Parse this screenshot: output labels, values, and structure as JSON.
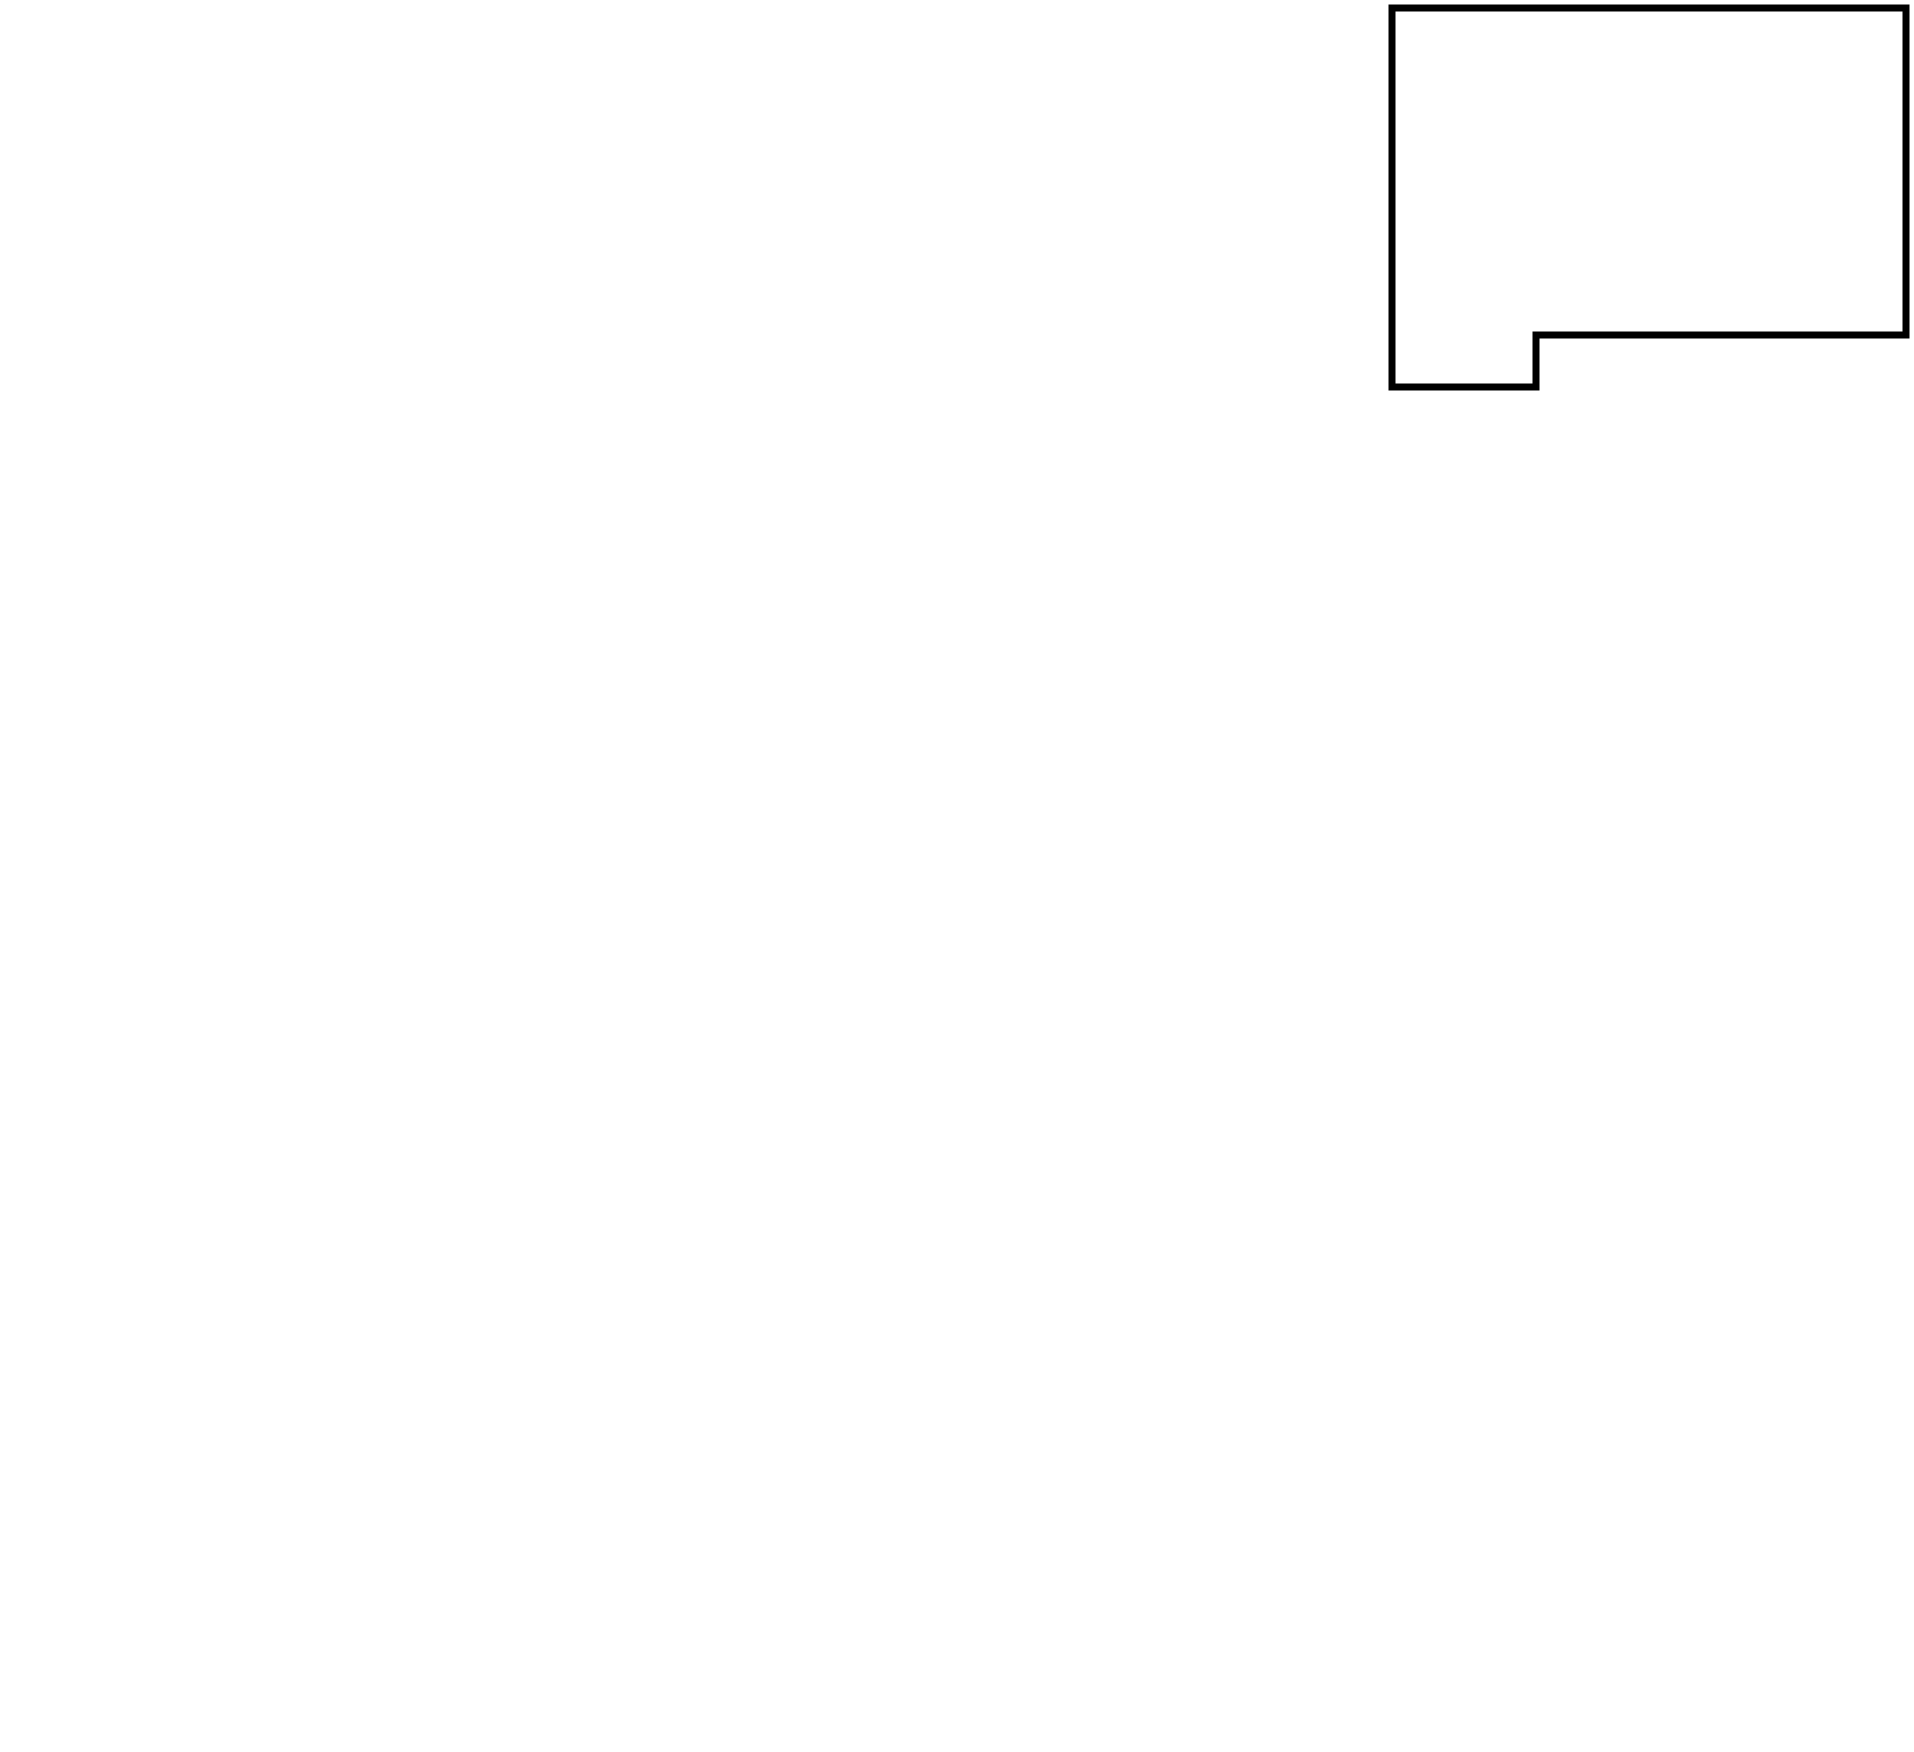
{
  "map": {
    "background_color": "#ffffff",
    "border_color": "#000000",
    "cell_fill_color": "#ffffff",
    "text_color": "#000000",
    "prefectures": [
      {
        "id": "hokkaido",
        "name": "北海道",
        "value": 19,
        "poly": [
          [
            1392,
            8
          ],
          [
            1906,
            8
          ],
          [
            1906,
            335
          ],
          [
            1536,
            335
          ],
          [
            1536,
            387
          ],
          [
            1392,
            387
          ]
        ],
        "label": [
          1628,
          180,
          "h"
        ]
      },
      {
        "id": "aomori",
        "name": "青森",
        "value": 12,
        "rect": [
          1390,
          430,
          372,
          113
        ],
        "label": [
          1578,
          492,
          "h"
        ]
      },
      {
        "id": "akita",
        "name": "秋田",
        "value": 7,
        "rect": [
          1390,
          543,
          188,
          139
        ],
        "label": [
          1484,
          616,
          "h"
        ]
      },
      {
        "id": "iwate",
        "name": "岩手",
        "value": 10,
        "rect": [
          1578,
          543,
          184,
          139
        ],
        "label": [
          1670,
          616,
          "h"
        ]
      },
      {
        "id": "yamagata",
        "name": "山形",
        "value": 2,
        "poly": [
          [
            1390,
            682
          ],
          [
            1578,
            682
          ],
          [
            1578,
            822
          ],
          [
            1462,
            822
          ],
          [
            1462,
            775
          ],
          [
            1390,
            775
          ]
        ],
        "label": [
          1518,
          756,
          "h"
        ]
      },
      {
        "id": "miyagi",
        "name": "宮城",
        "value": 8,
        "rect": [
          1578,
          682,
          184,
          140
        ],
        "label": [
          1670,
          748,
          "h"
        ]
      },
      {
        "id": "fukushima",
        "name": "福島",
        "value": 5,
        "rect": [
          1462,
          822,
          300,
          140
        ],
        "label": [
          1628,
          892,
          "h"
        ]
      },
      {
        "id": "niigata",
        "name": "新潟",
        "value": 5,
        "poly": [
          [
            1390,
            775
          ],
          [
            1462,
            775
          ],
          [
            1462,
            962
          ],
          [
            1285,
            962
          ],
          [
            1285,
            822
          ],
          [
            1390,
            822
          ]
        ],
        "label": [
          1374,
          892,
          "h"
        ]
      },
      {
        "id": "toyama",
        "name": "富山",
        "value": 3,
        "rect": [
          1143,
          822,
          142,
          140
        ],
        "label": [
          1214,
          892,
          "h"
        ]
      },
      {
        "id": "ishikawa",
        "name": "石川",
        "value": 8,
        "rect": [
          1047,
          780,
          96,
          182
        ],
        "label": [
          1095,
          875,
          "v"
        ]
      },
      {
        "id": "fukui",
        "name": "福井",
        "value": 6,
        "poly": [
          [
            1047,
            960
          ],
          [
            1143,
            960
          ],
          [
            1143,
            1100
          ],
          [
            957,
            1100
          ],
          [
            957,
            1003
          ],
          [
            1047,
            1003
          ]
        ],
        "label": [
          1052,
          1046,
          "h"
        ]
      },
      {
        "id": "gifu",
        "name": "岐阜",
        "value": null,
        "rect": [
          1143,
          960,
          92,
          368
        ],
        "label": [
          1189,
          1182,
          "v"
        ]
      },
      {
        "id": "nagano",
        "name": "長野",
        "value": null,
        "poly": [
          [
            1235,
            960
          ],
          [
            1397,
            960
          ],
          [
            1397,
            1212
          ],
          [
            1327,
            1212
          ],
          [
            1327,
            1328
          ],
          [
            1235,
            1328
          ]
        ],
        "label": [
          1313,
          1150,
          "h"
        ]
      },
      {
        "id": "gunma",
        "name": "群馬",
        "value": null,
        "rect": [
          1397,
          962,
          136,
          135
        ],
        "label": [
          1462,
          1033,
          "h"
        ]
      },
      {
        "id": "tochigi",
        "name": "栃木",
        "value": null,
        "rect": [
          1533,
          962,
          135,
          135
        ],
        "label": [
          1600,
          1033,
          "h"
        ]
      },
      {
        "id": "ibaraki",
        "name": "茨城",
        "value": 8,
        "rect": [
          1677,
          962,
          85,
          178
        ],
        "label": [
          1716,
          1041,
          "v"
        ]
      },
      {
        "id": "saitama",
        "name": "埼玉",
        "value": null,
        "rect": [
          1397,
          1097,
          271,
          115
        ],
        "label": [
          1535,
          1167,
          "h"
        ]
      },
      {
        "id": "yamanashi",
        "name": "山梨",
        "value": null,
        "rect": [
          1327,
          1212,
          138,
          116
        ],
        "label": [
          1394,
          1292,
          "h"
        ]
      },
      {
        "id": "tokyo",
        "name": "東京",
        "value": 7,
        "poly": [
          [
            1465,
            1212
          ],
          [
            1668,
            1212
          ],
          [
            1668,
            1279
          ],
          [
            1603,
            1279
          ],
          [
            1603,
            1328
          ],
          [
            1465,
            1328
          ]
        ],
        "label": [
          1548,
          1268,
          "h"
        ]
      },
      {
        "id": "chiba",
        "name": "千葉",
        "value": 19,
        "rect": [
          1677,
          1140,
          85,
          322
        ],
        "label": [
          1717,
          1278,
          "v"
        ]
      },
      {
        "id": "kanagawa",
        "name": "神奈川",
        "value": 13,
        "poly": [
          [
            1397,
            1328
          ],
          [
            1603,
            1328
          ],
          [
            1603,
            1467
          ],
          [
            1470,
            1467
          ],
          [
            1470,
            1399
          ],
          [
            1397,
            1399
          ]
        ],
        "label": [
          1512,
          1397,
          "h"
        ]
      },
      {
        "id": "shizuoka",
        "name": "静岡",
        "value": 14,
        "poly": [
          [
            1280,
            1328
          ],
          [
            1397,
            1328
          ],
          [
            1397,
            1399
          ],
          [
            1470,
            1399
          ],
          [
            1470,
            1467
          ],
          [
            1280,
            1467
          ]
        ],
        "label": [
          1339,
          1402,
          "h"
        ]
      },
      {
        "id": "aichi",
        "name": "愛知",
        "value": 7,
        "rect": [
          1143,
          1328,
          137,
          139
        ],
        "label": [
          1214,
          1402,
          "h"
        ]
      },
      {
        "id": "mie",
        "name": "三重",
        "value": 8,
        "rect": [
          1047,
          1238,
          96,
          323
        ],
        "label": [
          1092,
          1379,
          "v"
        ]
      },
      {
        "id": "shiga",
        "name": "滋賀",
        "value": null,
        "rect": [
          1047,
          1100,
          96,
          136
        ],
        "label": [
          1093,
          1177,
          "v"
        ]
      },
      {
        "id": "kyoto",
        "name": "京都",
        "value": 3,
        "poly": [
          [
            865,
            1003
          ],
          [
            957,
            1003
          ],
          [
            957,
            1100
          ],
          [
            1047,
            1100
          ],
          [
            1047,
            1236
          ],
          [
            865,
            1236
          ]
        ],
        "label": [
          955,
          1160,
          "h"
        ]
      },
      {
        "id": "osaka",
        "name": "大阪",
        "value": 4,
        "rect": [
          865,
          1238,
          92,
          161
        ],
        "label": [
          911,
          1316,
          "v"
        ]
      },
      {
        "id": "nara",
        "name": "奈良",
        "value": null,
        "rect": [
          957,
          1238,
          90,
          234
        ],
        "label": [
          1001,
          1360,
          "v"
        ]
      },
      {
        "id": "wakayama",
        "name": "和歌山",
        "value": 8,
        "poly": [
          [
            865,
            1399
          ],
          [
            957,
            1399
          ],
          [
            957,
            1472
          ],
          [
            1047,
            1472
          ],
          [
            1047,
            1561
          ],
          [
            865,
            1561
          ]
        ],
        "label": [
          953,
          1494,
          "h"
        ]
      },
      {
        "id": "hyogo",
        "name": "兵庫",
        "value": 7,
        "rect": [
          772,
          1003,
          93,
          282
        ],
        "label": [
          818,
          1141,
          "v"
        ]
      },
      {
        "id": "tottori",
        "name": "鳥取",
        "value": 4,
        "rect": [
          680,
          1003,
          92,
          142
        ],
        "label": [
          728,
          1079,
          "v"
        ]
      },
      {
        "id": "okayama",
        "name": "岡山",
        "value": 2,
        "rect": [
          680,
          1145,
          92,
          140
        ],
        "label": [
          729,
          1214,
          "v"
        ]
      },
      {
        "id": "shimane",
        "name": "島根",
        "value": 4,
        "rect": [
          588,
          1003,
          92,
          142
        ],
        "label": [
          634,
          1078,
          "v"
        ]
      },
      {
        "id": "hiroshima",
        "name": "広島",
        "value": 5,
        "rect": [
          588,
          1145,
          92,
          140
        ],
        "label": [
          637,
          1214,
          "v"
        ]
      },
      {
        "id": "yamaguchi",
        "name": "山口",
        "value": 6,
        "rect": [
          492,
          1003,
          96,
          282
        ],
        "label": [
          542,
          1126,
          "v"
        ]
      },
      {
        "id": "ehime",
        "name": "愛媛",
        "value": 11,
        "rect": [
          492,
          1323,
          165,
          120
        ],
        "label": [
          577,
          1384,
          "h"
        ]
      },
      {
        "id": "kagawa",
        "name": "香川",
        "value": 8,
        "rect": [
          657,
          1323,
          163,
          120
        ],
        "label": [
          738,
          1384,
          "h"
        ]
      },
      {
        "id": "kochi",
        "name": "高知",
        "value": 6,
        "rect": [
          492,
          1443,
          165,
          117
        ],
        "label": [
          577,
          1502,
          "h"
        ]
      },
      {
        "id": "tokushima",
        "name": "徳島",
        "value": 5,
        "rect": [
          657,
          1443,
          163,
          117
        ],
        "label": [
          738,
          1502,
          "h"
        ]
      },
      {
        "id": "nagasaki",
        "name": "長崎",
        "value": 9,
        "rect": [
          32,
          1003,
          98,
          212
        ],
        "label": [
          85,
          1122,
          "v"
        ]
      },
      {
        "id": "saga",
        "name": "佐賀",
        "value": 3,
        "rect": [
          130,
          1003,
          90,
          212
        ],
        "label": [
          177,
          1122,
          "v"
        ]
      },
      {
        "id": "fukuoka",
        "name": "福岡",
        "value": 7,
        "poly": [
          [
            220,
            1003
          ],
          [
            450,
            1003
          ],
          [
            450,
            1098
          ],
          [
            355,
            1098
          ],
          [
            355,
            1215
          ],
          [
            220,
            1215
          ]
        ],
        "label": [
          290,
          1102,
          "h"
        ]
      },
      {
        "id": "oita",
        "name": "大分",
        "value": 6,
        "rect": [
          355,
          1098,
          95,
          162
        ],
        "label": [
          404,
          1180,
          "v"
        ]
      },
      {
        "id": "kumamoto",
        "name": "熊本",
        "value": 5,
        "rect": [
          220,
          1215,
          135,
          207
        ],
        "label": [
          289,
          1318,
          "h"
        ]
      },
      {
        "id": "miyazaki",
        "name": "宮崎",
        "value": 6,
        "rect": [
          355,
          1260,
          95,
          162
        ],
        "label": [
          404,
          1336,
          "v"
        ]
      },
      {
        "id": "kagoshima",
        "name": "鹿児島",
        "value": 16,
        "rect": [
          220,
          1422,
          230,
          133
        ],
        "label": [
          340,
          1498,
          "h"
        ]
      },
      {
        "id": "okinawa",
        "name": "沖縄",
        "value": 28,
        "rect": [
          220,
          1603,
          97,
          144
        ],
        "label": [
          268,
          1678,
          "v"
        ]
      }
    ],
    "coast_outlines": [
      {
        "id": "hokkaido-coast",
        "poly": [
          [
            1392,
            8
          ],
          [
            1906,
            8
          ],
          [
            1906,
            335
          ],
          [
            1536,
            335
          ],
          [
            1536,
            387
          ],
          [
            1392,
            387
          ]
        ]
      },
      {
        "id": "honshu-coast",
        "poly": [
          [
            1390,
            430
          ],
          [
            1762,
            430
          ],
          [
            1762,
            1462
          ],
          [
            1677,
            1462
          ],
          [
            1677,
            1279
          ],
          [
            1603,
            1279
          ],
          [
            1603,
            1467
          ],
          [
            1143,
            1467
          ],
          [
            1143,
            1561
          ],
          [
            865,
            1561
          ],
          [
            865,
            1285
          ],
          [
            492,
            1285
          ],
          [
            492,
            1003
          ],
          [
            1047,
            1003
          ],
          [
            1047,
            780
          ],
          [
            1143,
            780
          ],
          [
            1143,
            822
          ],
          [
            1390,
            822
          ]
        ]
      },
      {
        "id": "shikoku-coast",
        "rect": [
          492,
          1323,
          328,
          237
        ]
      },
      {
        "id": "kyushu-coast",
        "poly": [
          [
            32,
            1003
          ],
          [
            450,
            1003
          ],
          [
            450,
            1555
          ],
          [
            220,
            1555
          ],
          [
            220,
            1215
          ],
          [
            32,
            1215
          ]
        ]
      },
      {
        "id": "okinawa-coast",
        "rect": [
          220,
          1603,
          97,
          144
        ]
      }
    ]
  }
}
